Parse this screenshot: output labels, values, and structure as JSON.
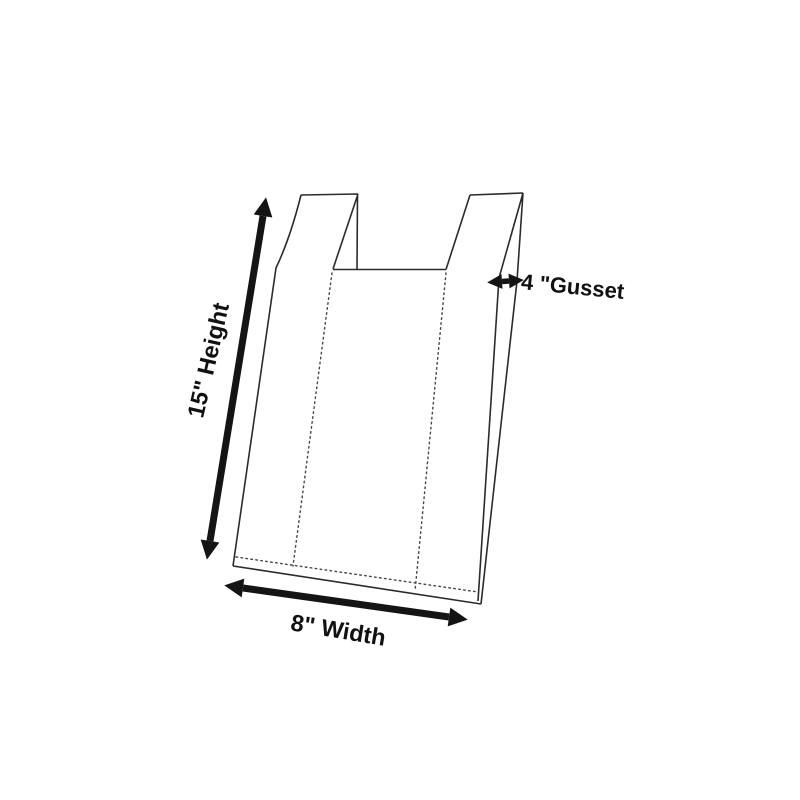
{
  "canvas": {
    "background_color": "#ffffff",
    "line_color": "#2b2b2b",
    "ink_color": "#141414"
  },
  "diagram": {
    "labels": {
      "height": "15\" Height",
      "width": "8\" Width",
      "gusset": "4 \"Gusset"
    },
    "icons": {
      "height_arrow": "double-headed-arrow",
      "width_arrow": "double-headed-arrow",
      "gusset_arrow": "double-headed-arrow"
    }
  }
}
